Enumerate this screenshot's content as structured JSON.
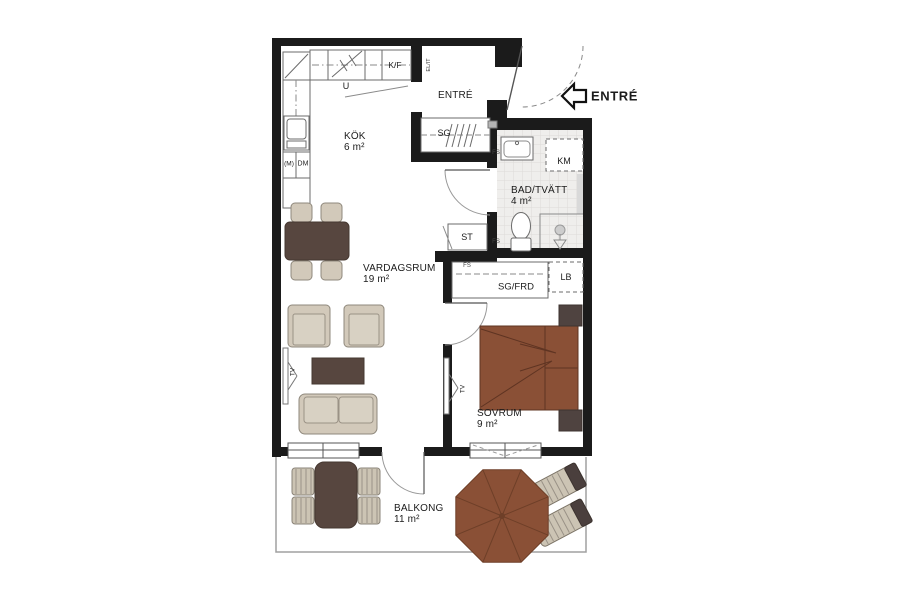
{
  "plan": {
    "rooms": [
      {
        "label": "KÖK",
        "area": "6 m²"
      },
      {
        "label": "VARDAGSRUM",
        "area": "19 m²"
      },
      {
        "label": "BAD/TVÄTT",
        "area": "4 m²"
      },
      {
        "label": "SOVRUM",
        "area": "9 m²"
      },
      {
        "label": "BALKONG",
        "area": "11 m²"
      },
      {
        "label": "ENTRÉ"
      }
    ],
    "entrance_label": "ENTRÉ",
    "fixtures": {
      "kf": "K/F",
      "u": "U",
      "el": "EL/IT",
      "sg": "SG",
      "km": "KM",
      "st": "ST",
      "lb": "LB",
      "sg_frd": "SG/FRD",
      "m": "(M)",
      "dm": "DM",
      "tv": "TV",
      "fs": "FS"
    },
    "colors": {
      "wall": "#1b1b1b",
      "wood_brown": "#8a5036",
      "dark_furniture": "#57463f",
      "upholstery": "#d2c9ba",
      "tile_floor": "#efeeec"
    }
  }
}
